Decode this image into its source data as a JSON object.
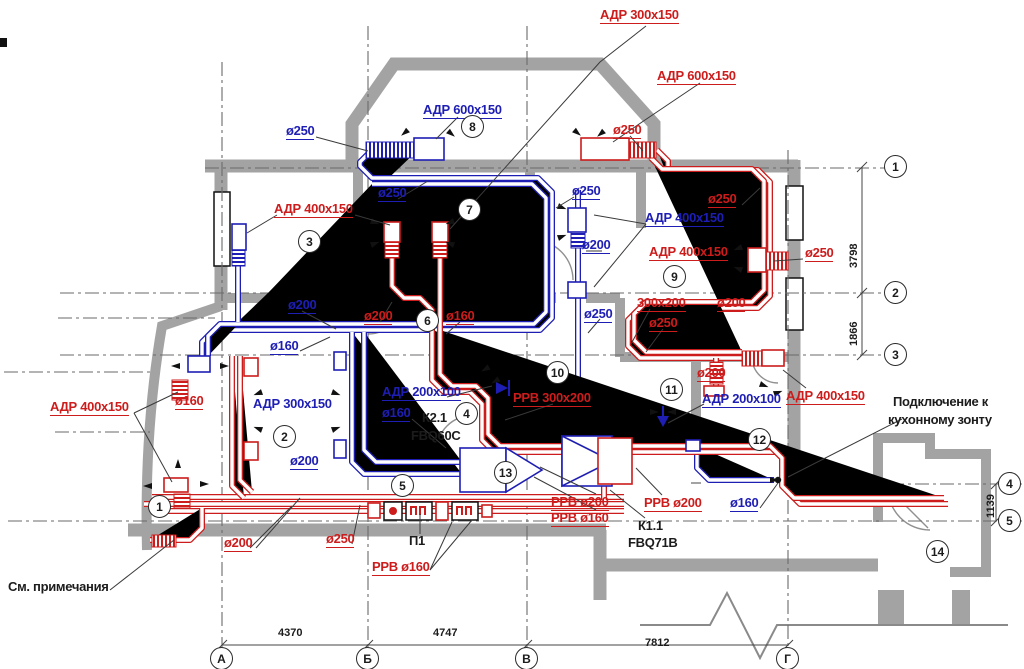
{
  "drawing": {
    "type": "ventilation-floor-plan",
    "supply_color": "#1e1eb4",
    "exhaust_color": "#cc1c1c",
    "wall_color": "#a3a3a3"
  },
  "labels": [
    {
      "t": "АДР 300x150",
      "c": "r",
      "x": 600,
      "y": 8,
      "u": 1
    },
    {
      "t": "АДР 600x150",
      "c": "r",
      "x": 657,
      "y": 69,
      "u": 1
    },
    {
      "t": "ø250",
      "c": "r",
      "x": 613,
      "y": 123,
      "u": 1
    },
    {
      "t": "АДР 600x150",
      "c": "b",
      "x": 423,
      "y": 103,
      "u": 1
    },
    {
      "t": "ø250",
      "c": "b",
      "x": 286,
      "y": 124,
      "u": 1
    },
    {
      "t": "ø250",
      "c": "b",
      "x": 378,
      "y": 186,
      "u": 1
    },
    {
      "t": "АДР 400x150",
      "c": "r",
      "x": 274,
      "y": 202,
      "u": 1
    },
    {
      "t": "ø250",
      "c": "b",
      "x": 572,
      "y": 184,
      "u": 1
    },
    {
      "t": "ø250",
      "c": "r",
      "x": 708,
      "y": 192,
      "u": 1
    },
    {
      "t": "АДР 400x150",
      "c": "b",
      "x": 645,
      "y": 211,
      "u": 1
    },
    {
      "t": "ø200",
      "c": "b",
      "x": 582,
      "y": 238,
      "u": 1
    },
    {
      "t": "АДР 400x150",
      "c": "r",
      "x": 649,
      "y": 245,
      "u": 1
    },
    {
      "t": "ø250",
      "c": "r",
      "x": 805,
      "y": 246,
      "u": 1
    },
    {
      "t": "300x200",
      "c": "r",
      "x": 637,
      "y": 296,
      "u": 1
    },
    {
      "t": "ø200",
      "c": "r",
      "x": 717,
      "y": 296,
      "u": 1
    },
    {
      "t": "ø250",
      "c": "r",
      "x": 649,
      "y": 316,
      "u": 1
    },
    {
      "t": "ø250",
      "c": "b",
      "x": 584,
      "y": 307,
      "u": 1
    },
    {
      "t": "ø200",
      "c": "b",
      "x": 288,
      "y": 298,
      "u": 1
    },
    {
      "t": "ø160",
      "c": "b",
      "x": 270,
      "y": 339,
      "u": 1
    },
    {
      "t": "ø200",
      "c": "r",
      "x": 364,
      "y": 309,
      "u": 1
    },
    {
      "t": "ø160",
      "c": "r",
      "x": 446,
      "y": 309,
      "u": 1
    },
    {
      "t": "АДР 300x150",
      "c": "b",
      "x": 253,
      "y": 397
    },
    {
      "t": "ø160",
      "c": "r",
      "x": 175,
      "y": 394,
      "u": 1
    },
    {
      "t": "АДР 400x150",
      "c": "r",
      "x": 50,
      "y": 400,
      "u": 1
    },
    {
      "t": "АДР 200x100",
      "c": "b",
      "x": 382,
      "y": 385,
      "u": 1
    },
    {
      "t": "ø160",
      "c": "b",
      "x": 382,
      "y": 406,
      "u": 1
    },
    {
      "t": "К2.1",
      "c": "k",
      "x": 422,
      "y": 411
    },
    {
      "t": "FBQ60C",
      "c": "k",
      "x": 411,
      "y": 429
    },
    {
      "t": "РРВ 300x200",
      "c": "r",
      "x": 513,
      "y": 391,
      "u": 1
    },
    {
      "t": "ø200",
      "c": "r",
      "x": 697,
      "y": 366,
      "u": 1
    },
    {
      "t": "АДР 200x100",
      "c": "b",
      "x": 702,
      "y": 392,
      "u": 1
    },
    {
      "t": "АДР 400x150",
      "c": "r",
      "x": 786,
      "y": 389,
      "u": 1
    },
    {
      "t": "Подключение к",
      "c": "k",
      "x": 893,
      "y": 395
    },
    {
      "t": "кухонному зонту",
      "c": "k",
      "x": 888,
      "y": 413
    },
    {
      "t": "ø200",
      "c": "b",
      "x": 290,
      "y": 454,
      "u": 1
    },
    {
      "t": "РРВ ø200",
      "c": "r",
      "x": 551,
      "y": 495,
      "u": 1
    },
    {
      "t": "РРВ ø160",
      "c": "r",
      "x": 551,
      "y": 511,
      "u": 1
    },
    {
      "t": "РРВ ø200",
      "c": "r",
      "x": 644,
      "y": 496,
      "u": 1
    },
    {
      "t": "ø160",
      "c": "b",
      "x": 730,
      "y": 496,
      "u": 1
    },
    {
      "t": "К1.1",
      "c": "k",
      "x": 638,
      "y": 519
    },
    {
      "t": "FBQ71B",
      "c": "k",
      "x": 628,
      "y": 536
    },
    {
      "t": "ø200",
      "c": "r",
      "x": 224,
      "y": 536,
      "u": 1
    },
    {
      "t": "ø250",
      "c": "r",
      "x": 326,
      "y": 532,
      "u": 1
    },
    {
      "t": "П1",
      "c": "k",
      "x": 409,
      "y": 534
    },
    {
      "t": "РРВ ø160",
      "c": "r",
      "x": 372,
      "y": 560,
      "u": 1
    },
    {
      "t": "См. примечания",
      "c": "k",
      "x": 8,
      "y": 580
    },
    {
      "t": "4370",
      "c": "k",
      "x": 278,
      "y": 628,
      "dim": 1
    },
    {
      "t": "4747",
      "c": "k",
      "x": 433,
      "y": 628,
      "dim": 1
    },
    {
      "t": "7812",
      "c": "k",
      "x": 645,
      "y": 638,
      "dim": 1
    },
    {
      "t": "3798",
      "c": "k",
      "x": 849,
      "y": 268,
      "dim": 1,
      "rot": -90
    },
    {
      "t": "1866",
      "c": "k",
      "x": 849,
      "y": 346,
      "dim": 1,
      "rot": -90
    },
    {
      "t": "1139",
      "c": "k",
      "x": 986,
      "y": 518,
      "dim": 1,
      "rot": -90
    }
  ],
  "rooms": [
    {
      "n": "1",
      "x": 160,
      "y": 507
    },
    {
      "n": "2",
      "x": 285,
      "y": 437
    },
    {
      "n": "3",
      "x": 310,
      "y": 242
    },
    {
      "n": "4",
      "x": 467,
      "y": 414
    },
    {
      "n": "5",
      "x": 403,
      "y": 486
    },
    {
      "n": "6",
      "x": 428,
      "y": 321
    },
    {
      "n": "7",
      "x": 470,
      "y": 210
    },
    {
      "n": "8",
      "x": 473,
      "y": 127
    },
    {
      "n": "9",
      "x": 675,
      "y": 277
    },
    {
      "n": "10",
      "x": 558,
      "y": 373
    },
    {
      "n": "11",
      "x": 672,
      "y": 390
    },
    {
      "n": "12",
      "x": 760,
      "y": 440
    },
    {
      "n": "13",
      "x": 506,
      "y": 473
    },
    {
      "n": "14",
      "x": 938,
      "y": 552
    }
  ],
  "axis_bubbles": [
    {
      "n": "А",
      "x": 222,
      "y": 659
    },
    {
      "n": "Б",
      "x": 368,
      "y": 659
    },
    {
      "n": "В",
      "x": 527,
      "y": 659
    },
    {
      "n": "Г",
      "x": 788,
      "y": 659
    },
    {
      "n": "1",
      "x": 896,
      "y": 167
    },
    {
      "n": "2",
      "x": 896,
      "y": 293
    },
    {
      "n": "3",
      "x": 896,
      "y": 355
    },
    {
      "n": "4",
      "x": 1010,
      "y": 484
    },
    {
      "n": "5",
      "x": 1010,
      "y": 521
    }
  ]
}
